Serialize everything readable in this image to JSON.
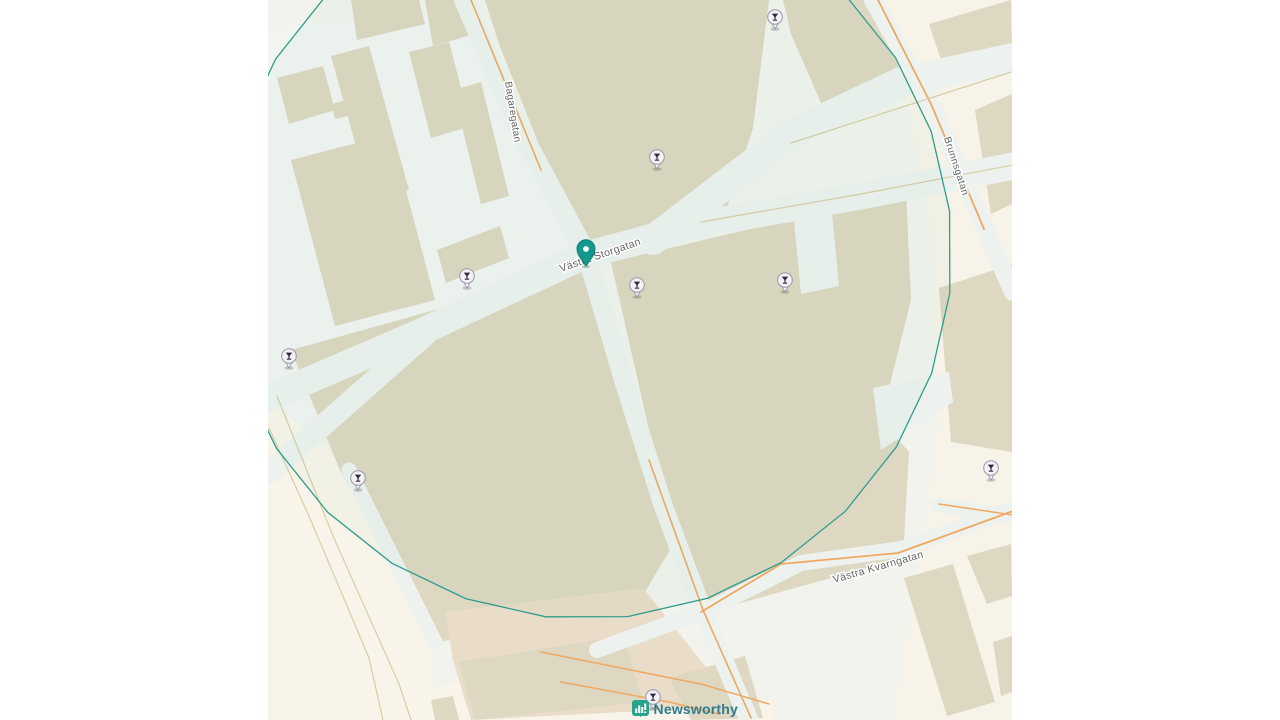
{
  "map": {
    "attribution": {
      "brand": "Newsworthy"
    },
    "streets": [
      {
        "id": "bagaregatan",
        "name": "Bagaregatan",
        "x": 237,
        "y": 82,
        "angle": 81,
        "size": 10
      },
      {
        "id": "brunnsgatan",
        "name": "Brunnsgatan",
        "x": 676,
        "y": 138,
        "angle": 72,
        "size": 10
      },
      {
        "id": "vastra-storgatan",
        "name": "Västra Storgatan",
        "x": 293,
        "y": 272,
        "angle": -19,
        "size": 10.5
      },
      {
        "id": "vastra-kvarngatan",
        "name": "Västra Kvarngatan",
        "x": 566,
        "y": 583,
        "angle": -16,
        "size": 10.5
      }
    ],
    "center_pin": {
      "x": 318,
      "y": 266,
      "label": "Västra Storgatan"
    },
    "geofence": {
      "cx": 318,
      "cy": 253,
      "r": 366,
      "sides": 28
    },
    "poi_markers": [
      {
        "icon": "bar-icon",
        "x": 507,
        "y": 17
      },
      {
        "icon": "bar-icon",
        "x": 389,
        "y": 157
      },
      {
        "icon": "bar-icon",
        "x": 199,
        "y": 276
      },
      {
        "icon": "bar-icon",
        "x": 369,
        "y": 285
      },
      {
        "icon": "bar-icon",
        "x": 517,
        "y": 280
      },
      {
        "icon": "bar-icon",
        "x": 21,
        "y": 356
      },
      {
        "icon": "bar-icon",
        "x": 90,
        "y": 478
      },
      {
        "icon": "bar-icon",
        "x": 723,
        "y": 468
      },
      {
        "icon": "bar-icon",
        "x": 385,
        "y": 697
      }
    ],
    "colors": {
      "base": "#f2f3ec",
      "cream": "#f7f3e8",
      "cream2": "#f9f4ea",
      "building": "#ded7c2",
      "tan_block": "#e9dcc8",
      "road": "#eef2ee",
      "road_minor": "#f5f7f4",
      "white": "#f2f4f0",
      "orange": "#eda962",
      "tan_line": "#d8cda4",
      "circle": "#2f9d8d",
      "pin": "#12998b",
      "pin_dark": "#0b7d72",
      "marker_fill": "#f3f1f6",
      "marker_stroke": "#9b94a8",
      "glyph": "#2f2a38",
      "brand_teal": "#2aa38c",
      "brand_text_color": "#2e7d91"
    },
    "geometry": {
      "land_patches": [
        {
          "fill": "white",
          "points": "0,30 193,0 253,140 318,255 163,330 0,475"
        },
        {
          "fill": "cream2",
          "points": "0,400 83,468 165,642 163,720 0,720"
        },
        {
          "fill": "cream",
          "points": "638,95 744,60 744,720 626,720 671,430 663,230"
        },
        {
          "fill": "cream",
          "points": "599,0 744,0 744,62 626,62"
        },
        {
          "fill": "cream2",
          "points": "133,692 333,662 505,702 505,720 133,720"
        }
      ],
      "buildings": [
        {
          "points": "9,78 55,66 67,110 21,124"
        },
        {
          "points": "63,104 79,100 83,115 67,119"
        },
        {
          "points": "63,56 101,46 141,190 103,200"
        },
        {
          "points": "141,52 181,42 203,126 163,138"
        },
        {
          "points": "83,0 151,0 157,24 89,40"
        },
        {
          "points": "157,0 197,0 207,34 165,46"
        },
        {
          "points": "185,90 213,82 241,196 213,204"
        },
        {
          "points": "23,160 123,134 167,300 67,326"
        },
        {
          "points": "169,250 232,226 241,258 178,283"
        },
        {
          "points": "217,0 501,0 485,128 457,214 321,248 273,150 231,44"
        },
        {
          "points": "515,0 605,0 641,82 557,112 523,34"
        },
        {
          "points": "661,24 743,0 744,54 681,84"
        },
        {
          "points": "707,110 744,94 744,204 723,214"
        },
        {
          "points": "671,288 744,264 744,452 683,442"
        },
        {
          "points": "23,350 325,266 381,446 409,538 377,592 165,644 71,468"
        },
        {
          "fill": "tan_block",
          "points": "177,612 375,588 469,706 203,720 185,660"
        },
        {
          "points": "343,262 638,192 643,300 613,420 641,452 635,558 433,614 381,430"
        },
        {
          "points": "636,578 685,564 727,702 679,716"
        },
        {
          "points": "699,556 743,544 744,596 719,604"
        },
        {
          "points": "725,642 744,636 744,692 733,696"
        },
        {
          "points": "191,662 355,636 375,702 207,720"
        },
        {
          "points": "401,678 477,656 495,718 423,720"
        },
        {
          "points": "163,700 185,696 191,720 167,720"
        }
      ],
      "white_patches": [
        {
          "points": "525,210 563,202 571,286 533,294"
        },
        {
          "points": "605,388 681,372 685,402 613,450"
        }
      ],
      "roads": [
        {
          "w": 27,
          "pts": [
            [
              -5,
              400
            ],
            [
              153,
              332
            ],
            [
              318,
              255
            ],
            [
              433,
              224
            ],
            [
              593,
              196
            ],
            [
              745,
              166
            ]
          ]
        },
        {
          "w": 30,
          "pts": [
            [
              385,
              240
            ],
            [
              523,
              134
            ],
            [
              633,
              82
            ],
            [
              745,
              58
            ]
          ]
        },
        {
          "w": 20,
          "pts": [
            [
              196,
              0
            ],
            [
              253,
              132
            ],
            [
              318,
              253
            ]
          ]
        },
        {
          "w": 19,
          "pts": [
            [
              318,
              253
            ],
            [
              357,
              385
            ],
            [
              395,
              505
            ],
            [
              435,
              612
            ],
            [
              481,
              720
            ]
          ]
        },
        {
          "w": 18,
          "pts": [
            [
              605,
              0
            ],
            [
              663,
              104
            ],
            [
              721,
              238
            ],
            [
              745,
              292
            ]
          ]
        },
        {
          "w": 16,
          "pts": [
            [
              329,
              650
            ],
            [
              439,
              610
            ],
            [
              533,
              563
            ],
            [
              633,
              549
            ],
            [
              745,
              509
            ]
          ]
        },
        {
          "w": 22,
          "pts": [
            [
              163,
              330
            ],
            [
              0,
              474
            ]
          ]
        },
        {
          "w": 15,
          "pts": [
            [
              81,
              470
            ],
            [
              167,
              642
            ]
          ]
        },
        {
          "w": 14,
          "pts": [
            [
              668,
              505
            ],
            [
              745,
              516
            ]
          ]
        }
      ],
      "orange_lines": [
        {
          "c": "orange",
          "w": 1.6,
          "pts": [
            [
              203,
              0
            ],
            [
              238,
              85
            ],
            [
              273,
              170
            ]
          ]
        },
        {
          "c": "orange",
          "w": 1.6,
          "pts": [
            [
              381,
              460
            ],
            [
              435,
              610
            ],
            [
              483,
              718
            ]
          ]
        },
        {
          "c": "orange",
          "w": 1.8,
          "pts": [
            [
              610,
              0
            ],
            [
              663,
              104
            ],
            [
              716,
              229
            ]
          ]
        },
        {
          "c": "orange",
          "w": 1.8,
          "pts": [
            [
              433,
              612
            ],
            [
              513,
              564
            ],
            [
              630,
              553
            ],
            [
              745,
              511
            ]
          ]
        },
        {
          "c": "orange",
          "w": 1.5,
          "pts": [
            [
              273,
              652
            ],
            [
              433,
              684
            ],
            [
              501,
              704
            ]
          ]
        },
        {
          "c": "orange",
          "w": 1.5,
          "pts": [
            [
              293,
              682
            ],
            [
              401,
              702
            ],
            [
              451,
              714
            ]
          ]
        },
        {
          "c": "orange",
          "w": 1.5,
          "pts": [
            [
              671,
              504
            ],
            [
              745,
              515
            ]
          ]
        },
        {
          "c": "tan_line",
          "w": 1.2,
          "pts": [
            [
              433,
              222
            ],
            [
              593,
              194
            ],
            [
              745,
              165
            ]
          ]
        },
        {
          "c": "tan_line",
          "w": 1.2,
          "pts": [
            [
              523,
              143
            ],
            [
              743,
              72
            ]
          ]
        },
        {
          "c": "tan_line",
          "w": 1.2,
          "pts": [
            [
              9,
              396
            ],
            [
              65,
              536
            ],
            [
              131,
              684
            ],
            [
              143,
              720
            ]
          ]
        },
        {
          "c": "tan_line",
          "w": 1.2,
          "pts": [
            [
              1,
              428
            ],
            [
              41,
              516
            ],
            [
              101,
              658
            ],
            [
              115,
              720
            ]
          ]
        }
      ]
    }
  }
}
